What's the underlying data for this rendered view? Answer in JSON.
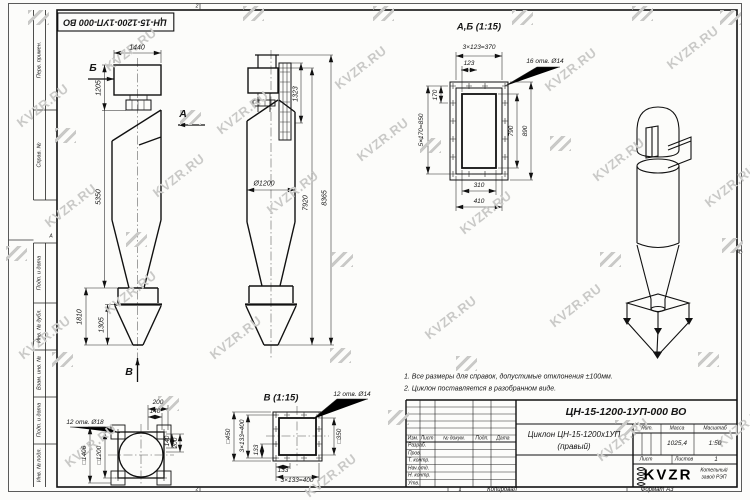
{
  "watermark": {
    "text": "KVZR.RU",
    "color": "#c9c9c7",
    "text_positions": [
      [
        12,
        98
      ],
      [
        100,
        42
      ],
      [
        212,
        105
      ],
      [
        330,
        60
      ],
      [
        540,
        62
      ],
      [
        662,
        40
      ],
      [
        40,
        198
      ],
      [
        148,
        168
      ],
      [
        262,
        185
      ],
      [
        352,
        132
      ],
      [
        588,
        152
      ],
      [
        700,
        178
      ],
      [
        14,
        330
      ],
      [
        100,
        285
      ],
      [
        420,
        310
      ],
      [
        545,
        298
      ],
      [
        60,
        438
      ],
      [
        300,
        468
      ],
      [
        592,
        432
      ],
      [
        712,
        418
      ],
      [
        205,
        330
      ],
      [
        455,
        205
      ]
    ],
    "logo_positions": [
      [
        28,
        10
      ],
      [
        243,
        6
      ],
      [
        373,
        6
      ],
      [
        512,
        10
      ],
      [
        632,
        6
      ],
      [
        720,
        10
      ],
      [
        55,
        128
      ],
      [
        180,
        110
      ],
      [
        420,
        138
      ],
      [
        550,
        136
      ],
      [
        6,
        246
      ],
      [
        126,
        232
      ],
      [
        332,
        252
      ],
      [
        600,
        252
      ],
      [
        722,
        238
      ],
      [
        52,
        352
      ],
      [
        330,
        348
      ],
      [
        456,
        356
      ],
      [
        698,
        352
      ],
      [
        158,
        396
      ],
      [
        388,
        410
      ],
      [
        615,
        420
      ]
    ]
  },
  "frame": {
    "left_cells": [
      "Перв. примен.",
      "Справ. №",
      "Подп. и дата",
      "Инв. № дубл.",
      "Взам. инв. №",
      "Подп. и дата",
      "Инв. № подл."
    ],
    "stamp": "ЦН-15-1200-1УП-000 ВО",
    "zone_top": "2",
    "zone_bottom_left": "2",
    "zone_bottom_mid": "1",
    "zone_row": "А"
  },
  "notes": {
    "line1": "1. Все размеры для справок, допустимые отклонения ±100мм.",
    "line2": "2. Циклон поставляется в разобранном виде."
  },
  "titleblock": {
    "designation": "ЦН-15-1200-1УП-000 ВО",
    "name_line1": "Циклон ЦН-15-1200х1УП",
    "name_line2": "(правый)",
    "lit_label": "Лит.",
    "mass_label": "Масса",
    "scale_label": "Масштаб",
    "mass_value": "1025,4",
    "scale_value": "1:50",
    "sheet_label": "Лист",
    "sheets_label": "Листов",
    "sheets_value": "1",
    "header": {
      "izm": "Изм.",
      "list": "Лист",
      "doc": "№ докум.",
      "podp": "Подп.",
      "data": "Дата"
    },
    "rows": [
      "Разраб.",
      "Пров.",
      "Т. контр.",
      "Нач.отд.",
      "Н. контр.",
      "Утв."
    ],
    "logo_text": "KVZR",
    "logo_sub1": "Котельный",
    "logo_sub2": "завод РЭП",
    "copied": "Копировал",
    "format": "Формат А3"
  },
  "views": {
    "front": {
      "arrow_b": "Б",
      "arrow_a": "А",
      "arrow_v": "В",
      "dim_width": "1440",
      "dim_inlet_h": "1205",
      "dim_body_h": "5350",
      "dim_bottom_h": "1810",
      "dim_cone_h": "1305"
    },
    "side": {
      "dim_top": "1323",
      "dim_dia": "Ø1200",
      "dim_h1": "7920",
      "dim_h2": "8365"
    },
    "section_ab": {
      "title": "А,Б (1:15)",
      "dim_pitch_top": "3×123=370",
      "dim_123": "123",
      "holes": "16 отв. Ø14",
      "dim_170": "170",
      "dim_pitch_side": "5×170=850",
      "dim_790": "790",
      "dim_890": "890",
      "dim_310": "310",
      "dim_410": "410"
    },
    "support_plan": {
      "holes": "12 отв. Ø18",
      "dim_200_top": "200",
      "dim_140_top": "140",
      "dim_140_right": "140",
      "dim_200_right": "200",
      "dim_sq1406": "□1406",
      "dim_sq1200": "□1200"
    },
    "view_v": {
      "title": "В (1:15)",
      "holes": "12 отв. Ø14",
      "dim_sq450": "□450",
      "dim_pitch_left": "3×133=400",
      "dim_133_left": "133",
      "dim_sq350": "□350",
      "dim_133_bottom": "133",
      "dim_pitch_bottom": "3×133=400"
    }
  }
}
